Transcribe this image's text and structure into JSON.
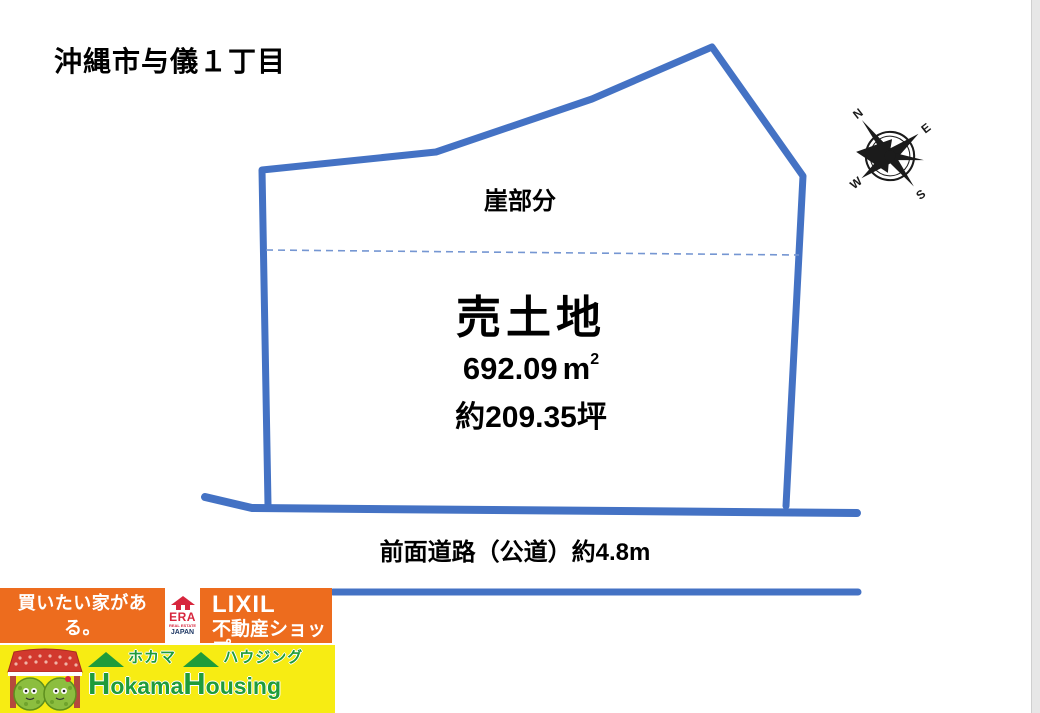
{
  "page": {
    "title": "沖縄市与儀１丁目"
  },
  "diagram": {
    "cliff_label": "崖部分",
    "sale_label": "売土地",
    "area_value": "692.09",
    "area_unit": "m",
    "area_exponent": "2",
    "tsubo_label": "約209.35坪",
    "road_label": "前面道路（公道）約4.8m",
    "outline_color": "#4472C4",
    "parcel_points": "268,505 262,170 436,152 592,99 712,47 803,176 786,506",
    "cliff_divider_points": "266,250 799,255",
    "front_road_points": "205,497 252,508 857,513",
    "lower_road_points": "333,592 858,592",
    "compass": {
      "n": "N",
      "e": "E",
      "s": "S",
      "w": "W"
    }
  },
  "branding": {
    "catch_line1": "買いたい家がある。",
    "catch_line2": "住みたい家にする。",
    "era": {
      "name": "ERA",
      "tagline": "REAL ESTATE",
      "region": "JAPAN"
    },
    "lixil": {
      "line1": "LIXIL",
      "line2": "不動産ショップ"
    },
    "hokama": {
      "kana1": "ホカマ",
      "kana2": "ハウジング",
      "en1_initial": "H",
      "en1_rest": "okama",
      "en2_initial": "H",
      "en2_rest": "ousing"
    },
    "colors": {
      "orange": "#ED6C1E",
      "yellow": "#F7EC13",
      "green": "#1F9C3A",
      "blue": "#4472C4"
    }
  }
}
